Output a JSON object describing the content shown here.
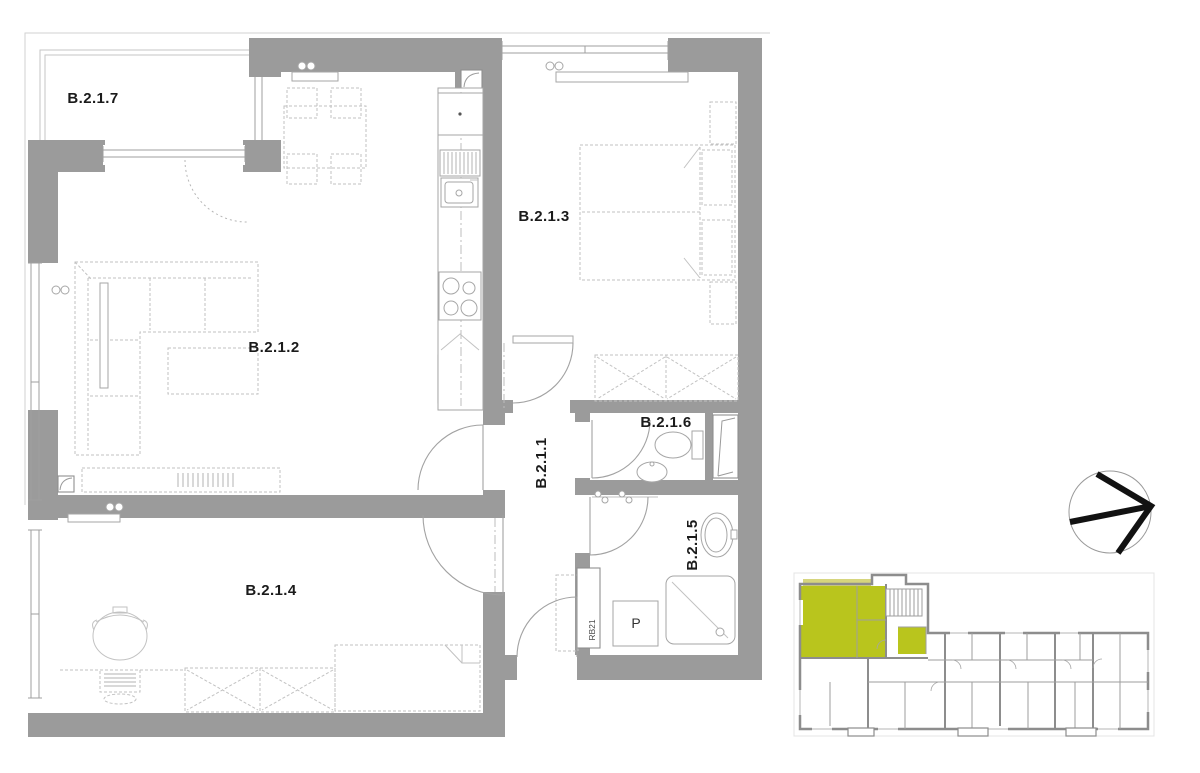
{
  "colors": {
    "wall": "#9b9b9b",
    "wallDark": "#8d8d8d",
    "furniture": "#c2c2c2",
    "faint": "#d2d2d2",
    "text": "#1b1b1b",
    "highlight": "#b9c51d",
    "highlightPale": "#d6d57e"
  },
  "plan": {
    "rooms": [
      {
        "id": "B.2.1.7",
        "label": "B.2.1.7"
      },
      {
        "id": "B.2.1.2",
        "label": "B.2.1.2"
      },
      {
        "id": "B.2.1.3",
        "label": "B.2.1.3"
      },
      {
        "id": "B.2.1.1",
        "label": "B.2.1.1"
      },
      {
        "id": "B.2.1.6",
        "label": "B.2.1.6"
      },
      {
        "id": "B.2.1.5",
        "label": "B.2.1.5"
      },
      {
        "id": "B.2.1.4",
        "label": "B.2.1.4"
      }
    ],
    "annotations": [
      {
        "id": "washing-machine",
        "label": "P"
      },
      {
        "id": "shaft",
        "label": "RB21"
      }
    ]
  },
  "compass": {
    "icon": "north-arrow"
  },
  "minimap": {
    "icon": "building-overview-map",
    "highlighted": true
  }
}
